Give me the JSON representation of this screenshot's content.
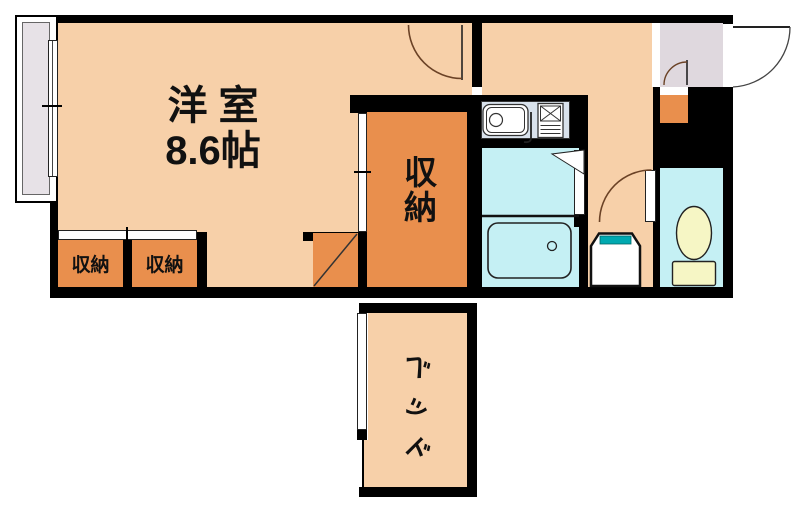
{
  "colors": {
    "wall": "#000000",
    "floor": "#F7D0A9",
    "closet": "#E98F4D",
    "bath": "#C5F0F4",
    "entrance": "#DFD8DE",
    "balcony": "#E7E2E7",
    "counter": "#D9E2EC",
    "fixture_yellow": "#F6F6C5",
    "teal": "#00A9B0",
    "arc": "#6B4226"
  },
  "rooms": {
    "main_room": {
      "name_line": "洋 室",
      "size_line": "8.6帖"
    },
    "closet_left": {
      "label": "収納"
    },
    "closet_right": {
      "label": "収納"
    },
    "storage": {
      "label": "収納"
    },
    "bed": {
      "label": "ベッド"
    }
  }
}
